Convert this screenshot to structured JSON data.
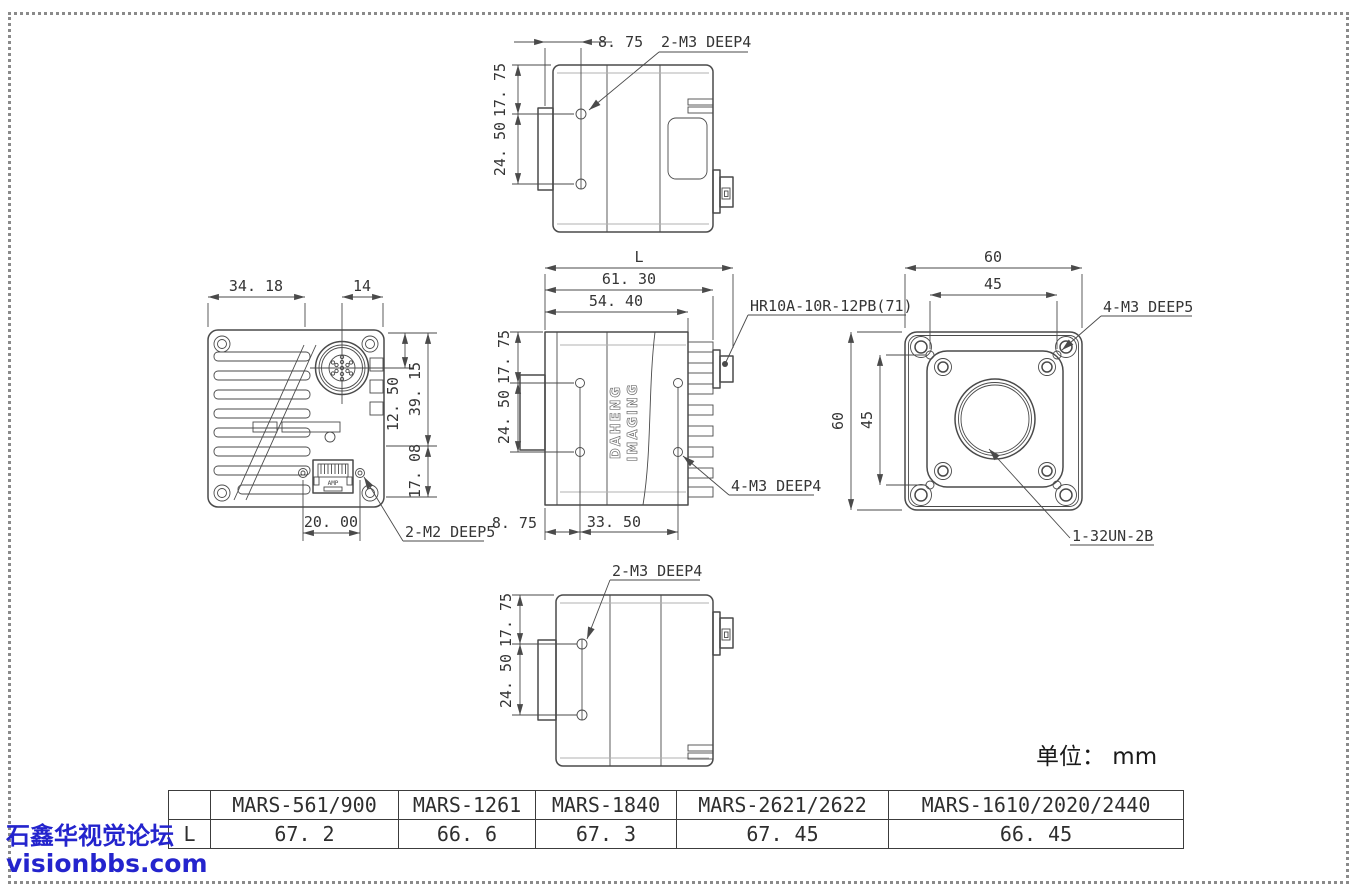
{
  "page": {
    "units_label": "单位： mm"
  },
  "watermark": {
    "line1": "石鑫华视觉论坛",
    "line2": "visionbbs.com",
    "color": "#2424cd"
  },
  "logo": {
    "line1": "DAHENG",
    "line2": "IMAGING"
  },
  "colors": {
    "line": "#4a4a4a",
    "text": "#353535",
    "watermark": "#2424cd"
  },
  "views": {
    "top": {
      "offset": "8. 75",
      "pitch1": "17. 75",
      "pitch2": "24. 50",
      "leader": "2-M3 DEEP4"
    },
    "back": {
      "width": "34. 18",
      "conn_offset": "14",
      "height_upper": "39. 15",
      "conn_center": "12. 50",
      "height_lower": "17. 08",
      "rj45_pitch": "20. 00",
      "leader": "2-M2 DEEP5",
      "port_label": "AMP"
    },
    "side": {
      "total": "L",
      "len_outer": "61. 30",
      "len_body": "54. 40",
      "pitch_v1": "17. 75",
      "pitch_v2": "24. 50",
      "offset": "8. 75",
      "pitch_h": "33. 50",
      "conn_leader": "HR10A-10R-12PB(71)",
      "holes_leader": "4-M3 DEEP4"
    },
    "front": {
      "width": "60",
      "width_inner": "45",
      "height": "60",
      "height_inner": "45",
      "screws_leader": "4-M3 DEEP5",
      "mount_leader": "1-32UN-2B"
    },
    "bottom": {
      "pitch1": "17. 75",
      "pitch2": "24. 50",
      "leader": "2-M3 DEEP4"
    }
  },
  "table": {
    "corner": "",
    "row_label": "L",
    "headers": [
      "MARS-561/900",
      "MARS-1261",
      "MARS-1840",
      "MARS-2621/2622",
      "MARS-1610/2020/2440"
    ],
    "values": [
      "67. 2",
      "66. 6",
      "67. 3",
      "67. 45",
      "66. 45"
    ]
  }
}
